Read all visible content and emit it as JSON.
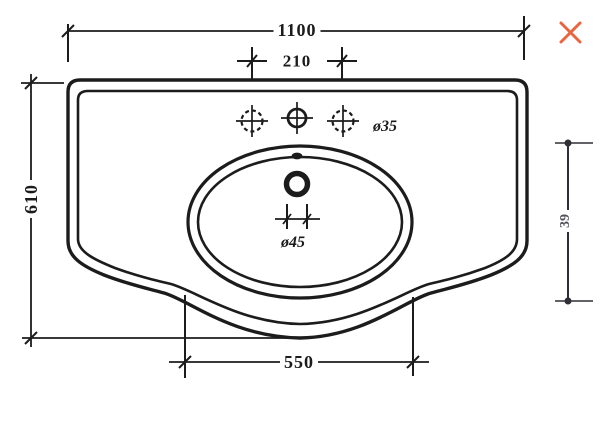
{
  "drawing": {
    "subject": "washbasin-technical-drawing-top-view",
    "dimensions": {
      "overall_width": "1100",
      "tap_hole_spacing": "210",
      "overall_depth": "610",
      "bowl_front_width": "550",
      "side_height": "39",
      "tap_hole_diameter": "ø35",
      "drain_hole_diameter": "ø45"
    },
    "colors": {
      "line": "#1c1c1c",
      "side_dimension_line": "#2f2f35",
      "side_dimension_text": "#52525c",
      "close_icon": "#e8653f",
      "background": "#ffffff"
    },
    "icons": {
      "close": "close-icon"
    }
  }
}
